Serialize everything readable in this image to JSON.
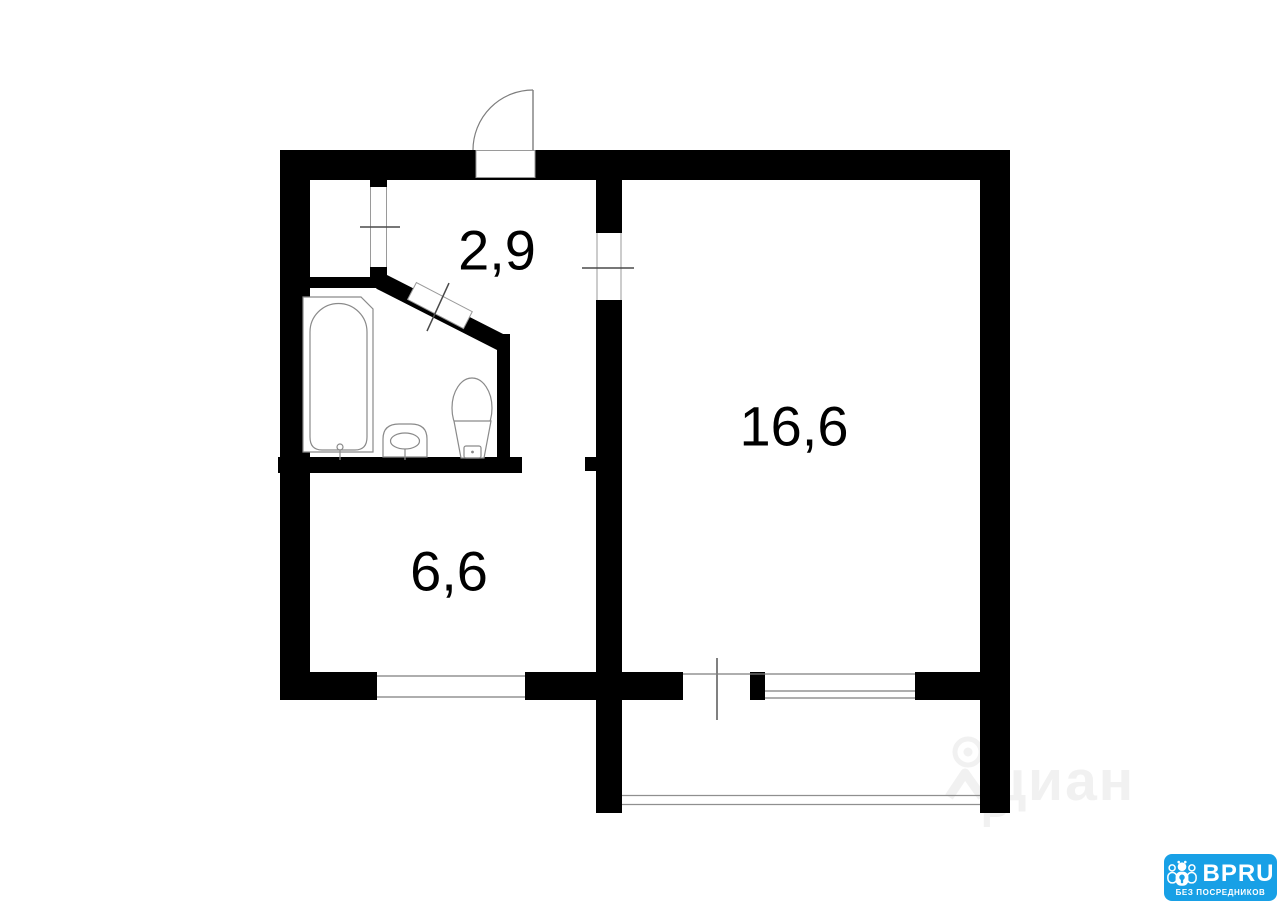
{
  "rooms": [
    {
      "id": "hallway",
      "area": "2,9"
    },
    {
      "id": "living-room",
      "area": "16,6"
    },
    {
      "id": "kitchen",
      "area": "6,6"
    }
  ],
  "fixtures": [
    "bathtub",
    "sink",
    "toilet"
  ],
  "watermark": {
    "text": "циан",
    "fragment": "Р"
  },
  "logo": {
    "brand": "BPRU",
    "tagline": "БЕЗ ПОСРЕДНИКОВ",
    "bg_color": "#18A0E6",
    "text_color": "#FFFFFF"
  },
  "colors": {
    "wall": "#000000",
    "background": "#FFFFFF",
    "fixture_line": "#8A8A8A",
    "watermark_gray": "#F1F1F1"
  }
}
